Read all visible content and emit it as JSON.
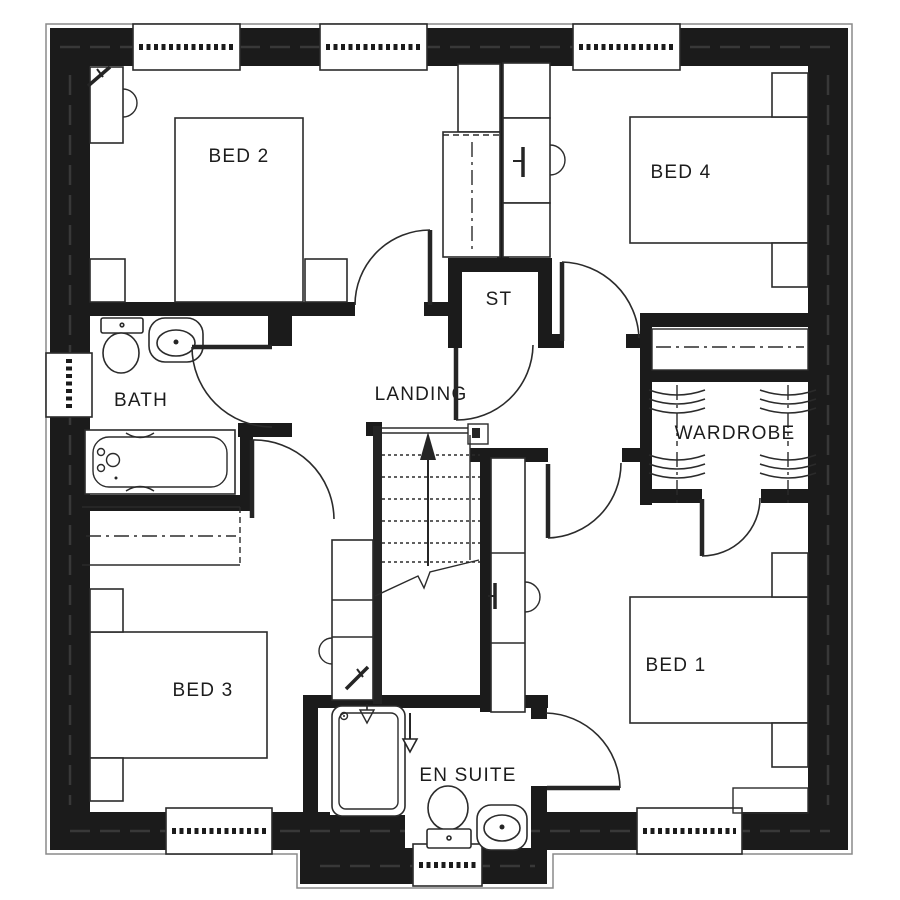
{
  "plan": {
    "type": "floor-plan",
    "rooms": [
      {
        "id": "bed2",
        "label": "BED 2"
      },
      {
        "id": "bed4",
        "label": "BED 4"
      },
      {
        "id": "st",
        "label": "ST"
      },
      {
        "id": "landing",
        "label": "LANDING"
      },
      {
        "id": "bath",
        "label": "BATH"
      },
      {
        "id": "wardrobe",
        "label": "WARDROBE"
      },
      {
        "id": "bed3",
        "label": "BED 3"
      },
      {
        "id": "bed1",
        "label": "BED 1"
      },
      {
        "id": "ensuite",
        "label": "EN SUITE"
      }
    ],
    "icons": {
      "bath_fixtures": [
        "toilet-icon",
        "washbasin-icon",
        "bathtub-icon"
      ],
      "ensuite_fixtures": [
        "shower-icon",
        "toilet-icon",
        "washbasin-icon",
        "down-arrow-icon"
      ],
      "stairs": "stairs-up-arrow-icon",
      "wardrobe": "hanging-rail-icon",
      "windows": "window-icon",
      "doors": "door-swing-icon"
    },
    "colors": {
      "wall": "#1b1b1b",
      "floor": "#ffffff",
      "line": "#2b2b2b"
    }
  }
}
